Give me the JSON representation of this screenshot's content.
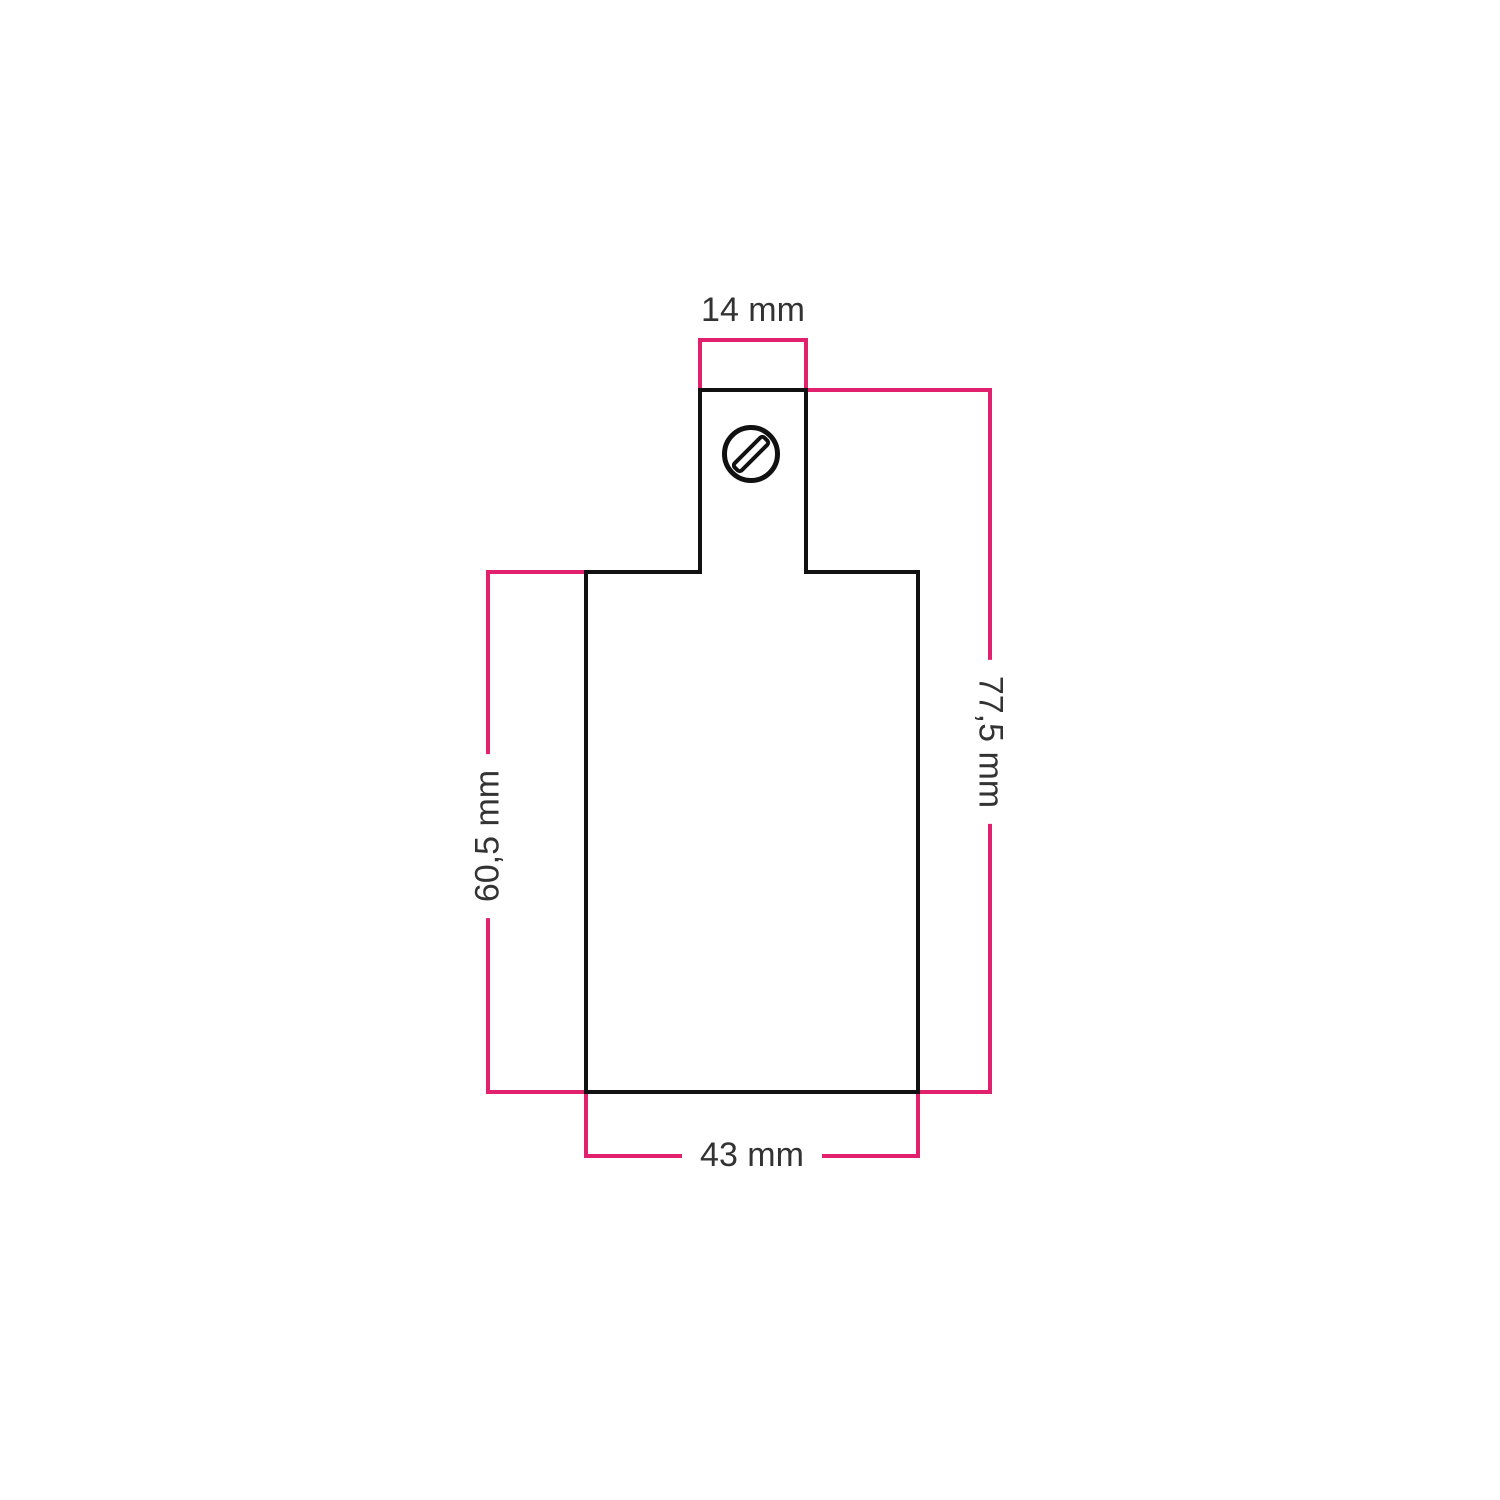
{
  "diagram": {
    "colors": {
      "dimension": "#e2216e",
      "outline": "#111111",
      "label": "#333333"
    },
    "labels": {
      "top_width": "14 mm",
      "right_height": "77,5 mm",
      "left_height": "60,5 mm",
      "bottom_width": "43 mm"
    }
  }
}
